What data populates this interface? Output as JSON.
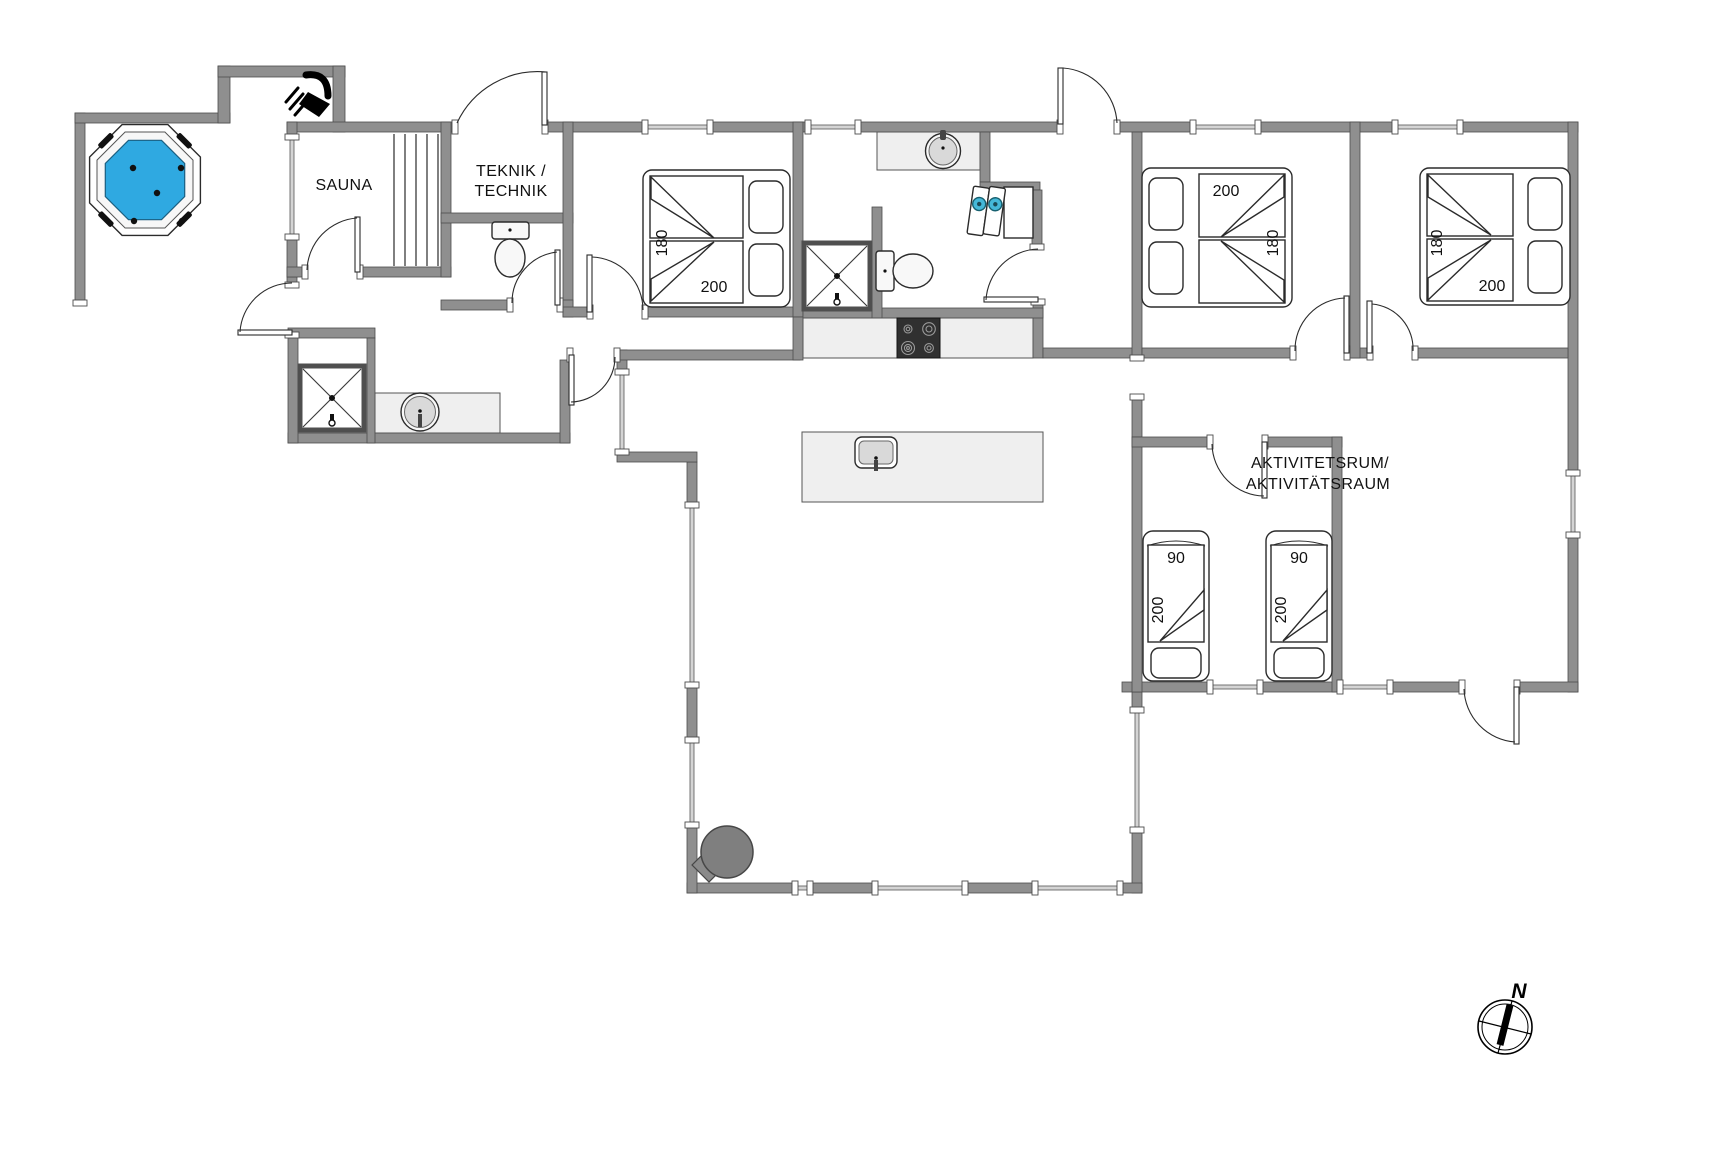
{
  "colors": {
    "wall": "#8f8f8f",
    "hot_tub_water": "#2fa9e1",
    "washer_door": "#45b8d8",
    "counter": "#efefef",
    "stove_top": "#303030"
  },
  "rooms": {
    "sauna": "SAUNA",
    "teknik_line1": "TEKNIK /",
    "teknik_line2": "TECHNIK",
    "activity_line1": "AKTIVITETSRUM/",
    "activity_line2": "AKTIVITÄTSRAUM"
  },
  "compass": {
    "north": "N"
  },
  "beds": {
    "bedroom_left": {
      "width": "180",
      "length": "200"
    },
    "bedroom_middle": {
      "width": "180",
      "length": "200"
    },
    "bedroom_right": {
      "width": "180",
      "length": "200"
    },
    "single_bed_1": {
      "width": "90",
      "length": "200"
    },
    "single_bed_2": {
      "width": "90",
      "length": "200"
    }
  },
  "icons": {
    "hot_tub": "octagonal-whirlpool",
    "outdoor_shower": "shower-head",
    "wood_stove": "round-stove-with-flue",
    "compass": "north-compass-rose"
  }
}
